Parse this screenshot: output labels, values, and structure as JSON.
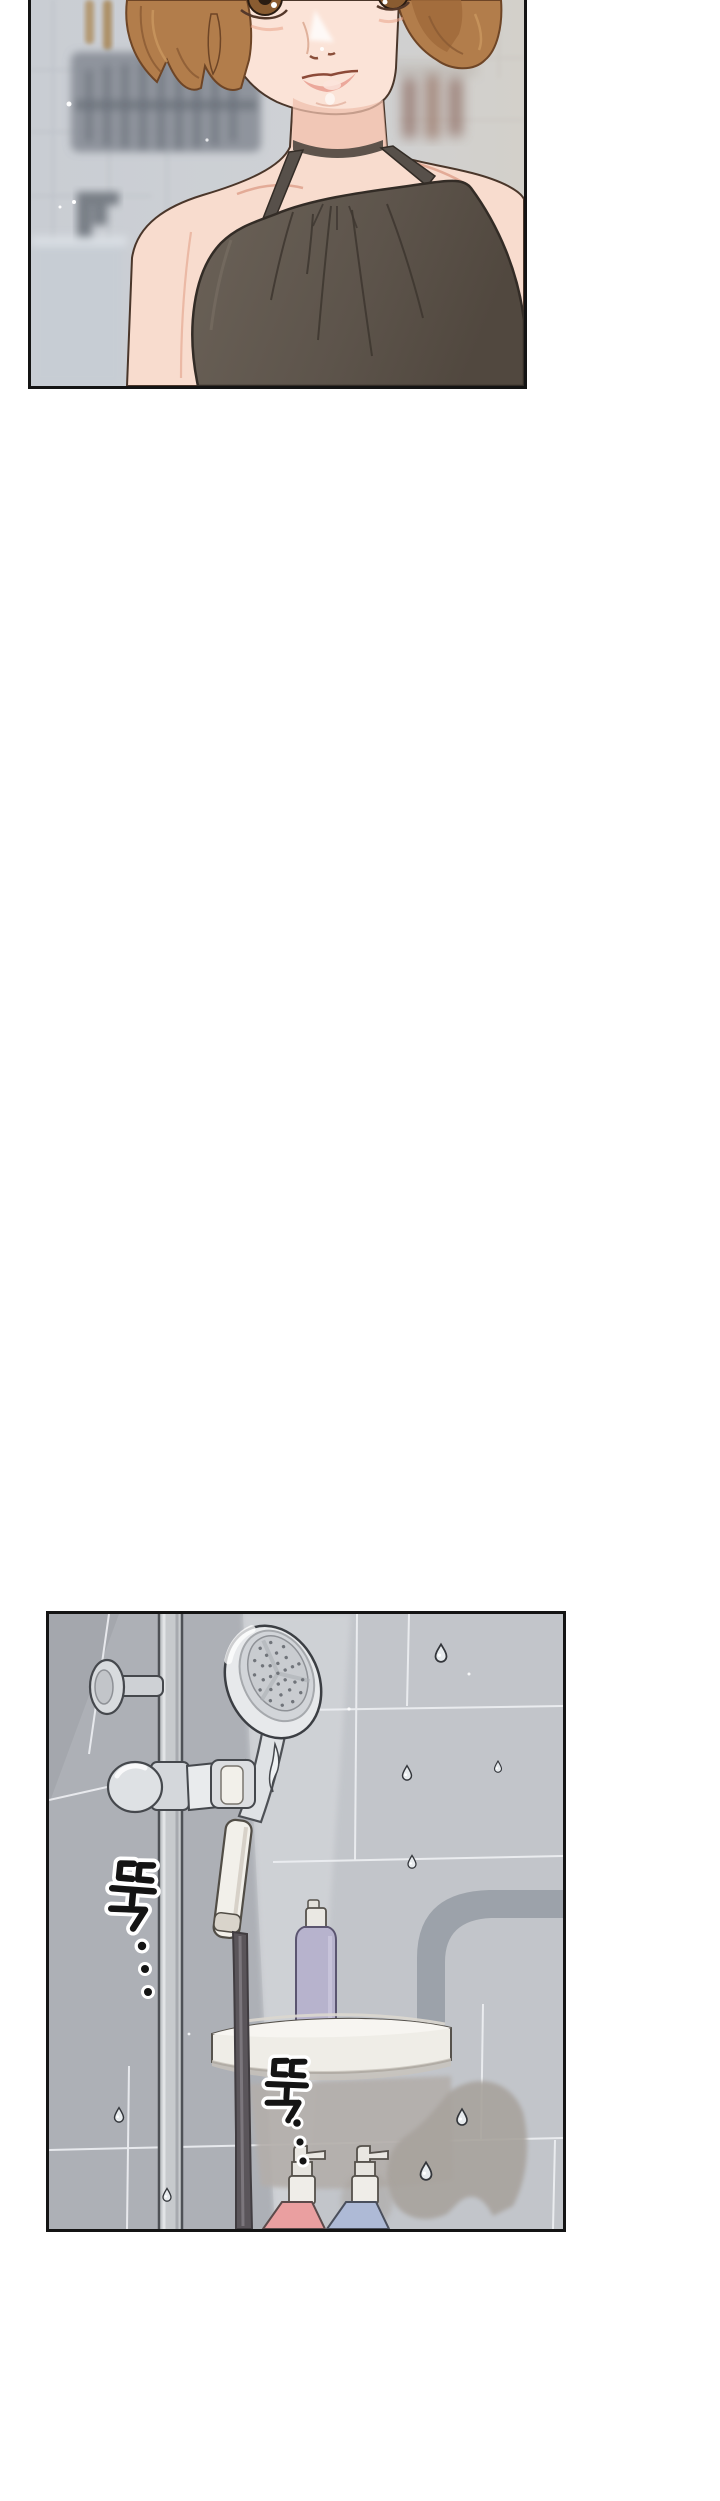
{
  "page": {
    "width_px": 720,
    "height_px": 2501,
    "background_color": "#ffffff",
    "kind": "vertical webtoon strip segment"
  },
  "panels": [
    {
      "id": "panel-kitchen-closeup",
      "alt": "Close-up of a short-haired woman in a dark halter top standing in a blurred kitchen",
      "left_px": 28,
      "top_px": 0,
      "width_px": 499,
      "height_px": 389,
      "border_color": "#141414",
      "palette": {
        "wall_cool": "#c9cdd3",
        "wall_warm": "#d3d0ca",
        "dish_rack": "#7f868f",
        "counter": "#c7cdd4",
        "hair": "#b27d4b",
        "hair_shadow": "#8a5a33",
        "skin": "#f8dcce",
        "skin_shadow": "#efc0ae",
        "eye_iris": "#8a5c31",
        "lips": "#e79e90",
        "halter_top": "#6b6258",
        "halter_shadow": "#51483f",
        "outline": "#33271f"
      }
    },
    {
      "id": "panel-shower-wall",
      "alt": "Gray tiled shower wall with handheld shower head on a rail, corner shelf with a lavender bottle, two pump bottles and dripping water",
      "left_px": 46,
      "top_px": 1611,
      "width_px": 520,
      "height_px": 621,
      "border_color": "#141414",
      "sfx": [
        {
          "text": "뚝",
          "dots": "⋮"
        },
        {
          "text": "뚝",
          "dots": "⋮"
        }
      ],
      "palette": {
        "tile": "#c2c5ca",
        "tile_dark": "#adb0b6",
        "tile_light": "#d0d3d7",
        "grout": "#eef0f3",
        "metal": "#c7cacd",
        "metal_outline": "#45484d",
        "shower_face": "#c9ccd0",
        "hose": "#5a555a",
        "handle": "#f2f0ea",
        "shelf": "#efede7",
        "bottle_lavender": "#b7b3cd",
        "bottle_pink": "#ea9fa0",
        "bottle_blue": "#aebad6",
        "pump_white": "#efede8",
        "shadow_blob": "#a8a39d",
        "pipe_silhouette": "#9aa0a8",
        "sfx_ink": "#141414"
      }
    }
  ]
}
